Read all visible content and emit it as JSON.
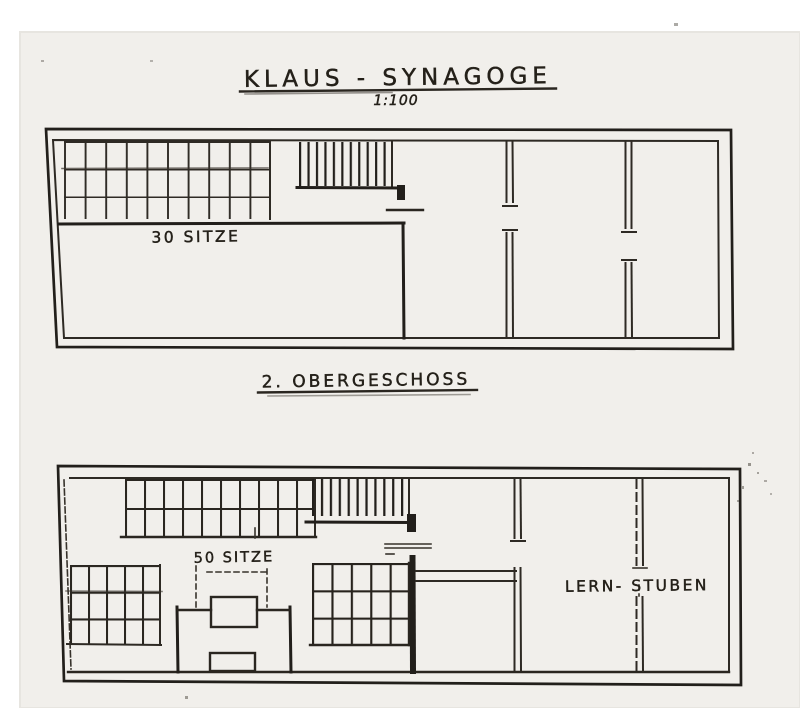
{
  "labels": {
    "title": "KLAUS - SYNAGOGE",
    "scale": "1:100",
    "floor_heading": "2. OBERGESCHOSS",
    "upper_seats": "30 SITZE",
    "lower_seats": "50 SITZE",
    "lern_stuben": "LERN- STUBEN"
  },
  "colors": {
    "ink": "#242019",
    "paper": "#f1efeb",
    "margin": "#ffffff"
  }
}
